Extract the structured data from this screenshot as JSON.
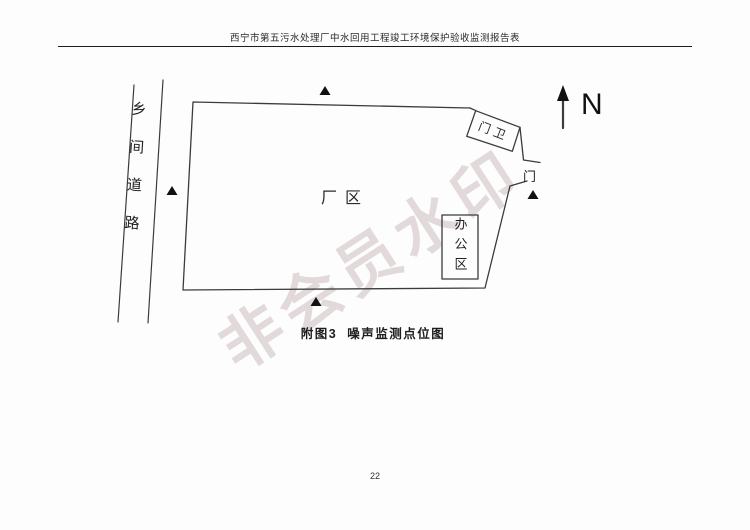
{
  "page": {
    "header_title": "西宁市第五污水处理厂中水回用工程竣工环境保护验收监测报告表",
    "caption": "附图3  噪声监测点位图",
    "page_number": "22",
    "watermark_text": "非会员水印"
  },
  "diagram": {
    "type": "site-plan",
    "road_label": "乡间道路",
    "plant_area_label": "厂区",
    "gatehouse_label": "门卫",
    "gate_label": "门",
    "office_area_label": "办公区",
    "north_label": "N",
    "monitoring_point_marker": "▲",
    "monitoring_points": [
      {
        "marker": "▲",
        "location": "north boundary of plant area"
      },
      {
        "marker": "▲",
        "location": "west boundary beside country road"
      },
      {
        "marker": "▲",
        "location": "east boundary beside gate"
      },
      {
        "marker": "▲",
        "location": "south boundary of plant area"
      }
    ]
  },
  "colors": {
    "page_background": "#fdfdfd",
    "line_color": "#3b3b3b",
    "text_color": "#222222",
    "watermark_color": "#c1b0b0"
  }
}
